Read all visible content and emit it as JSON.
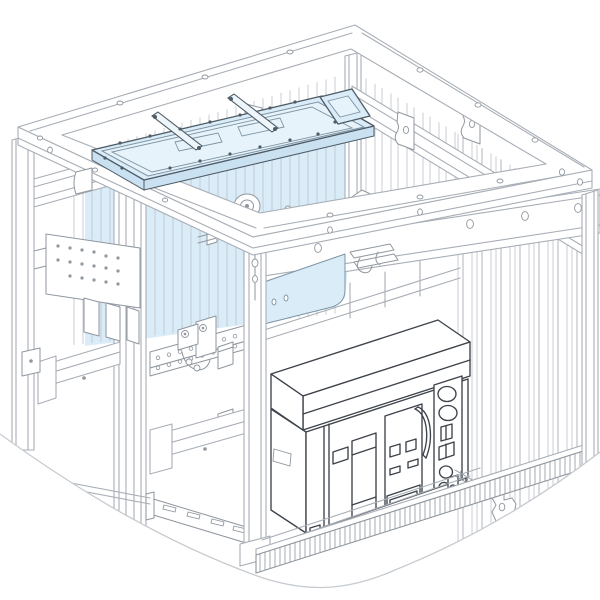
{
  "meta": {
    "description": "Isometric technical line drawing of a switchboard cubicle frame with a withdrawable air circuit breaker installed; a pale-blue highlighted busbar linking tray and rear insulation panels are shown mounted in the top of the metal framework.",
    "document_type": "installation-illustration"
  },
  "palette": {
    "bg": "#ffffff",
    "line-light": "#a8aeb6",
    "line-lighter": "#c2c8cf",
    "line-med": "#8f979f",
    "line-dark": "#3d434a",
    "blue-fill": "#d9ecf8",
    "blue-fill-light": "#e7f3fa",
    "blue-fill-shade": "#c9e1f1",
    "blue-edge": "#7e93a4",
    "blue-dark": "#4f5c66",
    "teal-dot": "#8ec9cd",
    "curve-edge": "#c6cbd0"
  },
  "components": {
    "enclosure_frame": "cubicle framework",
    "roof_frame": "top frame ring",
    "mid_frame": "intermediate frame ring",
    "blue_tray": "busbar linking tray (highlighted)",
    "blue_panels": "rear insulating panels (highlighted)",
    "insulators": "busbar support insulators",
    "breaker": "air circuit breaker",
    "drawout_rail": "draw-out guide rail",
    "base_rail": "plinth front rail",
    "side_panels": "ribbed side panels"
  }
}
